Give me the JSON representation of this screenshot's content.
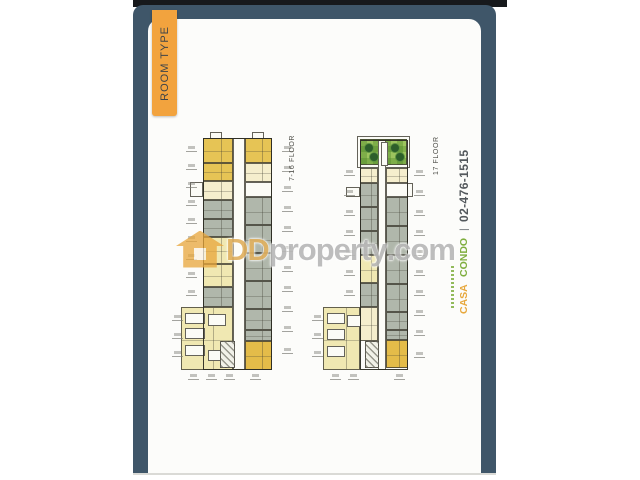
{
  "tab": {
    "label": "ROOM TYPE"
  },
  "watermark": {
    "dd": "DD",
    "property_text": "property",
    "dotcom": ".com",
    "house_icon": "house-icon"
  },
  "branding": {
    "casa": "CASA",
    "condo": "CONDO",
    "separator": "|",
    "phone": "02-476-1515"
  },
  "palette": {
    "frame": "#3f5669",
    "top_strip": "#17191c",
    "tab_bg": "#f2a33e",
    "tab_text": "#3f4449",
    "gold": "#e6c455",
    "gold2": "#e4bc49",
    "cream": "#f5eecd",
    "pale": "#f0e8b2",
    "gray": "#b0b7ab",
    "white_unit": "#fbfbf6",
    "corridor": "#fcfcf7",
    "green": "#9cc45e",
    "tree": "#2d5f2b",
    "casa": "#e7a83d",
    "condo": "#7fae3f",
    "phone": "#53585c",
    "label": "#4c4c46",
    "watermark_amber": "#e8a63c"
  },
  "floorplans": [
    {
      "id": "left-tower",
      "label": "7-16 FLOOR",
      "label_pos": {
        "x": 289,
        "y": 132,
        "h": 52
      },
      "units": [
        {
          "x": 233,
          "y": 138,
          "w": 12,
          "h": 232,
          "f": "corridor"
        },
        {
          "x": 210,
          "y": 132,
          "w": 12,
          "h": 7,
          "f": "white"
        },
        {
          "x": 252,
          "y": 132,
          "w": 12,
          "h": 7,
          "f": "white"
        },
        {
          "x": 203,
          "y": 138,
          "w": 30,
          "h": 25,
          "f": "gold"
        },
        {
          "x": 203,
          "y": 163,
          "w": 30,
          "h": 18,
          "f": "gold"
        },
        {
          "x": 203,
          "y": 181,
          "w": 30,
          "h": 19,
          "f": "cream"
        },
        {
          "x": 203,
          "y": 200,
          "w": 30,
          "h": 19,
          "f": "gray"
        },
        {
          "x": 203,
          "y": 219,
          "w": 30,
          "h": 18,
          "f": "gray"
        },
        {
          "x": 203,
          "y": 237,
          "w": 30,
          "h": 27,
          "f": "pale"
        },
        {
          "x": 203,
          "y": 264,
          "w": 30,
          "h": 23,
          "f": "pale"
        },
        {
          "x": 203,
          "y": 287,
          "w": 30,
          "h": 20,
          "f": "gray"
        },
        {
          "x": 190,
          "y": 182,
          "w": 13,
          "h": 15,
          "f": "white"
        },
        {
          "x": 245,
          "y": 138,
          "w": 27,
          "h": 25,
          "f": "gold"
        },
        {
          "x": 245,
          "y": 163,
          "w": 27,
          "h": 19,
          "f": "cream"
        },
        {
          "x": 245,
          "y": 182,
          "w": 27,
          "h": 15,
          "f": "white"
        },
        {
          "x": 245,
          "y": 197,
          "w": 27,
          "h": 28,
          "f": "gray"
        },
        {
          "x": 245,
          "y": 225,
          "w": 27,
          "h": 28,
          "f": "gray"
        },
        {
          "x": 245,
          "y": 253,
          "w": 27,
          "h": 28,
          "f": "gray"
        },
        {
          "x": 245,
          "y": 281,
          "w": 27,
          "h": 28,
          "f": "gray"
        },
        {
          "x": 245,
          "y": 309,
          "w": 27,
          "h": 21,
          "f": "gray"
        },
        {
          "x": 245,
          "y": 330,
          "w": 27,
          "h": 11,
          "f": "gray"
        },
        {
          "x": 245,
          "y": 341,
          "w": 27,
          "h": 29,
          "f": "gold2"
        },
        {
          "x": 181,
          "y": 307,
          "w": 52,
          "h": 63,
          "f": "pale"
        },
        {
          "x": 185,
          "y": 313,
          "w": 20,
          "h": 11,
          "f": "white"
        },
        {
          "x": 185,
          "y": 328,
          "w": 20,
          "h": 11,
          "f": "white"
        },
        {
          "x": 185,
          "y": 345,
          "w": 20,
          "h": 11,
          "f": "white"
        },
        {
          "x": 208,
          "y": 314,
          "w": 18,
          "h": 12,
          "f": "white"
        },
        {
          "x": 208,
          "y": 350,
          "w": 18,
          "h": 11,
          "f": "white"
        },
        {
          "x": 220,
          "y": 341,
          "w": 15,
          "h": 27,
          "f": "hatch"
        },
        {
          "x": 203,
          "y": 138,
          "w": 69,
          "h": 232,
          "f": "outline"
        }
      ],
      "ticks": [
        {
          "x": 186,
          "y": 146
        },
        {
          "x": 186,
          "y": 164
        },
        {
          "x": 186,
          "y": 182
        },
        {
          "x": 186,
          "y": 200
        },
        {
          "x": 186,
          "y": 218
        },
        {
          "x": 186,
          "y": 236
        },
        {
          "x": 186,
          "y": 254
        },
        {
          "x": 186,
          "y": 272
        },
        {
          "x": 186,
          "y": 290
        },
        {
          "x": 172,
          "y": 315
        },
        {
          "x": 172,
          "y": 333
        },
        {
          "x": 172,
          "y": 351
        },
        {
          "x": 282,
          "y": 146
        },
        {
          "x": 282,
          "y": 166
        },
        {
          "x": 282,
          "y": 186
        },
        {
          "x": 282,
          "y": 206
        },
        {
          "x": 282,
          "y": 226
        },
        {
          "x": 282,
          "y": 246
        },
        {
          "x": 282,
          "y": 266
        },
        {
          "x": 282,
          "y": 286
        },
        {
          "x": 282,
          "y": 306
        },
        {
          "x": 282,
          "y": 326
        },
        {
          "x": 282,
          "y": 348
        },
        {
          "x": 188,
          "y": 374
        },
        {
          "x": 206,
          "y": 374
        },
        {
          "x": 224,
          "y": 374
        },
        {
          "x": 250,
          "y": 374
        }
      ],
      "trees": []
    },
    {
      "id": "right-tower",
      "label": "17 FLOOR",
      "label_pos": {
        "x": 433,
        "y": 137,
        "h": 38
      },
      "units": [
        {
          "x": 357,
          "y": 136,
          "w": 53,
          "h": 32,
          "f": "white"
        },
        {
          "x": 360,
          "y": 139,
          "w": 47,
          "h": 26,
          "f": "green"
        },
        {
          "x": 378,
          "y": 140,
          "w": 8,
          "h": 230,
          "f": "corridor"
        },
        {
          "x": 381,
          "y": 142,
          "w": 7,
          "h": 24,
          "f": "corridor"
        },
        {
          "x": 360,
          "y": 168,
          "w": 18,
          "h": 15,
          "f": "cream"
        },
        {
          "x": 360,
          "y": 183,
          "w": 18,
          "h": 24,
          "f": "gray"
        },
        {
          "x": 360,
          "y": 207,
          "w": 18,
          "h": 24,
          "f": "gray"
        },
        {
          "x": 360,
          "y": 231,
          "w": 18,
          "h": 24,
          "f": "gray"
        },
        {
          "x": 360,
          "y": 255,
          "w": 18,
          "h": 28,
          "f": "pale"
        },
        {
          "x": 360,
          "y": 283,
          "w": 18,
          "h": 24,
          "f": "gray"
        },
        {
          "x": 346,
          "y": 187,
          "w": 14,
          "h": 10,
          "f": "white"
        },
        {
          "x": 386,
          "y": 168,
          "w": 22,
          "h": 15,
          "f": "cream"
        },
        {
          "x": 386,
          "y": 183,
          "w": 27,
          "h": 14,
          "f": "white"
        },
        {
          "x": 386,
          "y": 197,
          "w": 22,
          "h": 29,
          "f": "gray"
        },
        {
          "x": 386,
          "y": 226,
          "w": 22,
          "h": 29,
          "f": "gray"
        },
        {
          "x": 386,
          "y": 255,
          "w": 22,
          "h": 29,
          "f": "gray"
        },
        {
          "x": 386,
          "y": 284,
          "w": 22,
          "h": 28,
          "f": "gray"
        },
        {
          "x": 386,
          "y": 312,
          "w": 22,
          "h": 18,
          "f": "gray"
        },
        {
          "x": 386,
          "y": 330,
          "w": 22,
          "h": 10,
          "f": "gray"
        },
        {
          "x": 386,
          "y": 340,
          "w": 22,
          "h": 28,
          "f": "gold2"
        },
        {
          "x": 323,
          "y": 307,
          "w": 37,
          "h": 63,
          "f": "pale"
        },
        {
          "x": 360,
          "y": 307,
          "w": 18,
          "h": 34,
          "f": "cream"
        },
        {
          "x": 327,
          "y": 313,
          "w": 18,
          "h": 11,
          "f": "white"
        },
        {
          "x": 327,
          "y": 329,
          "w": 18,
          "h": 11,
          "f": "white"
        },
        {
          "x": 327,
          "y": 346,
          "w": 18,
          "h": 11,
          "f": "white"
        },
        {
          "x": 347,
          "y": 315,
          "w": 14,
          "h": 12,
          "f": "white"
        },
        {
          "x": 365,
          "y": 341,
          "w": 14,
          "h": 27,
          "f": "hatch"
        },
        {
          "x": 360,
          "y": 140,
          "w": 48,
          "h": 230,
          "f": "outline"
        }
      ],
      "ticks": [
        {
          "x": 344,
          "y": 170
        },
        {
          "x": 344,
          "y": 190
        },
        {
          "x": 344,
          "y": 210
        },
        {
          "x": 344,
          "y": 230
        },
        {
          "x": 344,
          "y": 250
        },
        {
          "x": 344,
          "y": 270
        },
        {
          "x": 344,
          "y": 290
        },
        {
          "x": 312,
          "y": 315
        },
        {
          "x": 312,
          "y": 333
        },
        {
          "x": 312,
          "y": 351
        },
        {
          "x": 414,
          "y": 170
        },
        {
          "x": 414,
          "y": 190
        },
        {
          "x": 414,
          "y": 210
        },
        {
          "x": 414,
          "y": 230
        },
        {
          "x": 414,
          "y": 250
        },
        {
          "x": 414,
          "y": 270
        },
        {
          "x": 414,
          "y": 290
        },
        {
          "x": 414,
          "y": 310
        },
        {
          "x": 414,
          "y": 330
        },
        {
          "x": 414,
          "y": 352
        },
        {
          "x": 330,
          "y": 374
        },
        {
          "x": 348,
          "y": 374
        },
        {
          "x": 394,
          "y": 374
        }
      ],
      "trees": [
        {
          "cx": 369,
          "cy": 148,
          "r": 5
        },
        {
          "cx": 374,
          "cy": 157,
          "r": 5
        },
        {
          "cx": 395,
          "cy": 148,
          "r": 5
        },
        {
          "cx": 400,
          "cy": 157,
          "r": 5
        }
      ]
    }
  ]
}
